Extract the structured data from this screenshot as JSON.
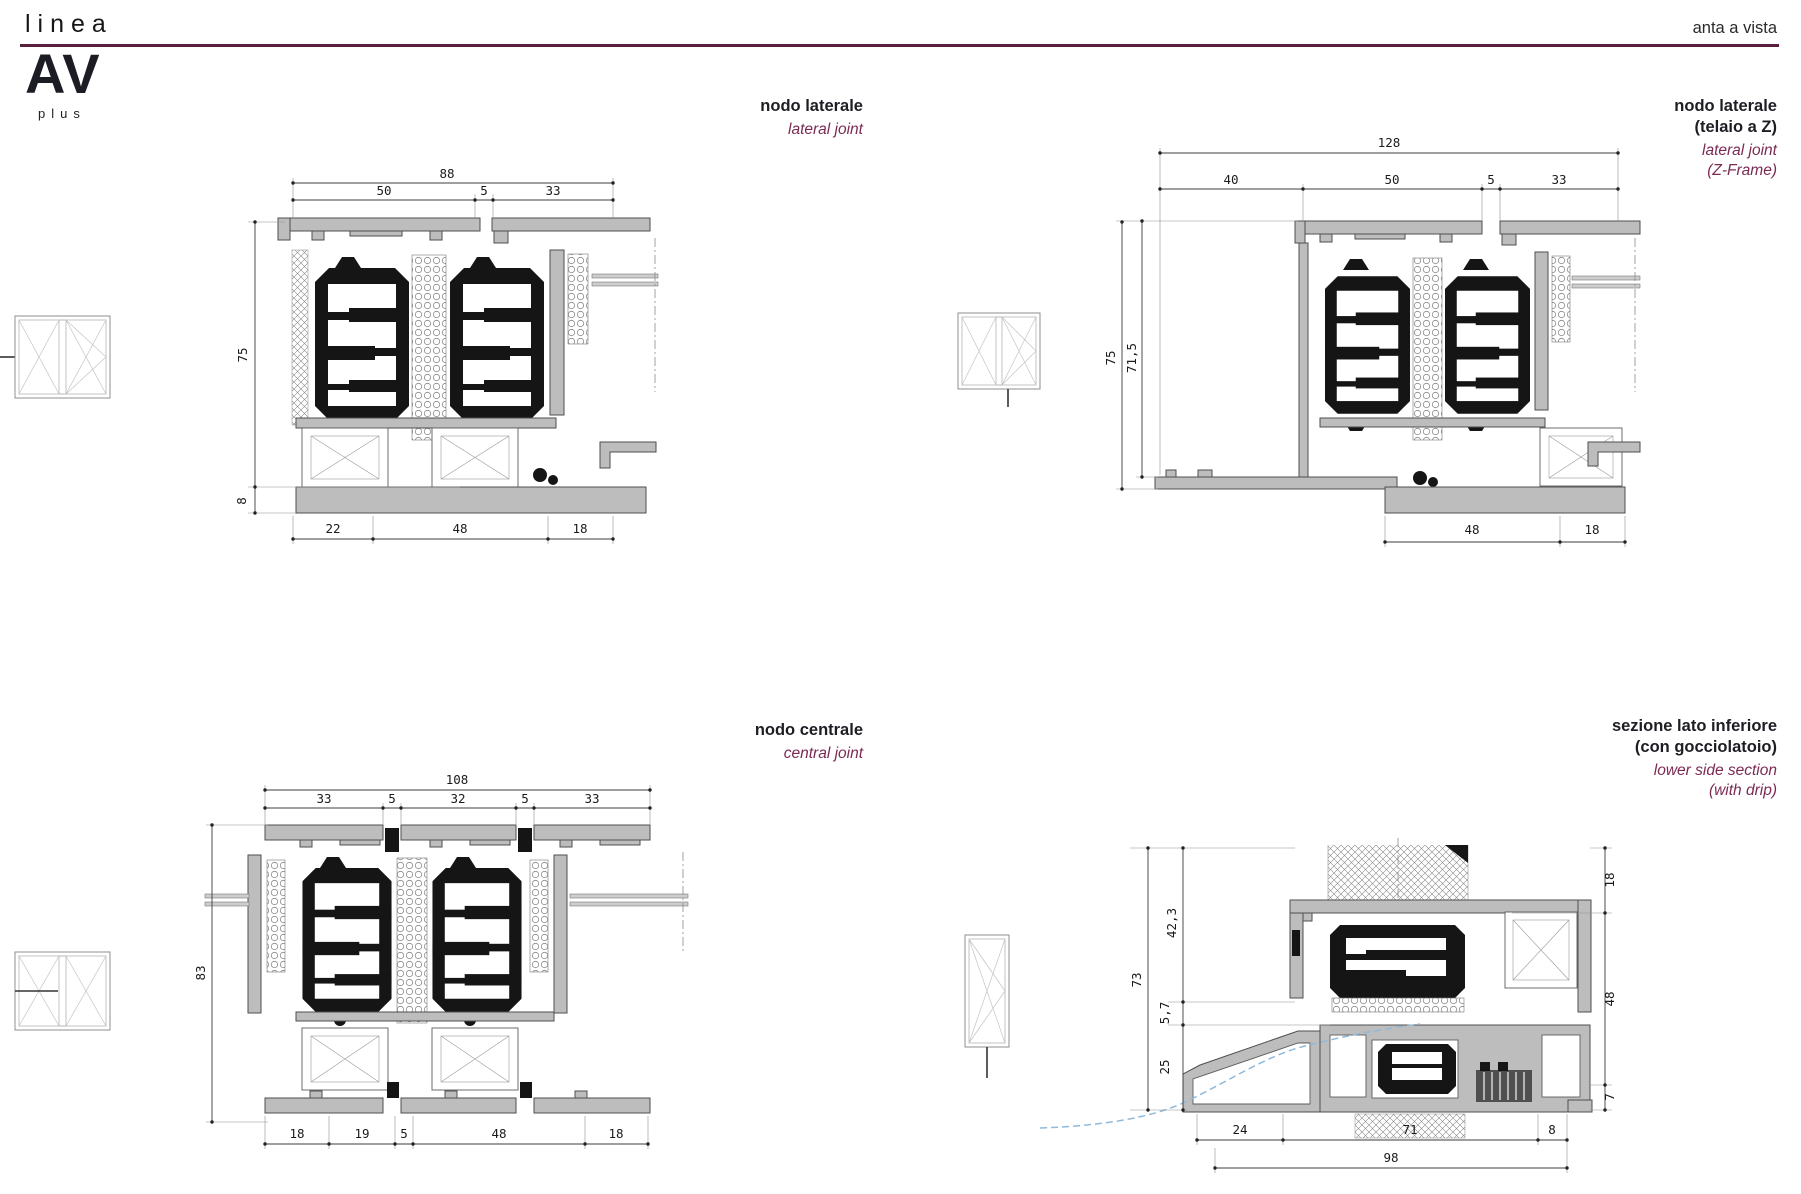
{
  "page": {
    "background": "#ffffff",
    "accent_rule_color": "#571e3d",
    "subtitle_color": "#7b2a52"
  },
  "header": {
    "brand_script": "linea",
    "logo": "AV",
    "logo_sub": "plus",
    "page_label": "anta a vista"
  },
  "quadrants": [
    {
      "id": "lateral-joint",
      "title_lines": [
        "nodo laterale"
      ],
      "subtitle_lines": [
        "lateral joint"
      ],
      "window_icon": "double-casement-window-elevation-icon",
      "dims": {
        "top_total": "88",
        "top": [
          "50",
          "5",
          "33"
        ],
        "left": [
          "75",
          "8"
        ],
        "bottom": [
          "22",
          "48",
          "18"
        ]
      }
    },
    {
      "id": "lateral-joint-z-frame",
      "title_lines": [
        "nodo laterale",
        "(telaio a Z)"
      ],
      "subtitle_lines": [
        "lateral joint",
        "(Z-Frame)"
      ],
      "window_icon": "double-casement-tilt-turn-window-elevation-icon",
      "dims": {
        "top_total": "128",
        "top": [
          "40",
          "50",
          "5",
          "33"
        ],
        "left": [
          "75",
          "71,5"
        ],
        "bottom": [
          "48",
          "18"
        ]
      }
    },
    {
      "id": "central-joint",
      "title_lines": [
        "nodo centrale"
      ],
      "subtitle_lines": [
        "central joint"
      ],
      "window_icon": "double-casement-window-elevation-icon",
      "dims": {
        "top_total": "108",
        "top": [
          "33",
          "5",
          "32",
          "5",
          "33"
        ],
        "left": [
          "83"
        ],
        "bottom": [
          "18",
          "19",
          "5",
          "48",
          "18"
        ]
      }
    },
    {
      "id": "lower-side-section-with-drip",
      "title_lines": [
        "sezione lato inferiore",
        "(con gocciolatoio)"
      ],
      "subtitle_lines": [
        "lower side section",
        "(with drip)"
      ],
      "window_icon": "tall-sash-window-elevation-icon",
      "dims": {
        "left": [
          "73",
          "42,3",
          "5,7",
          "25"
        ],
        "right": [
          "18",
          "48",
          "7"
        ],
        "bottom": [
          "24",
          "71",
          "8"
        ],
        "bottom_total": "98"
      }
    }
  ]
}
